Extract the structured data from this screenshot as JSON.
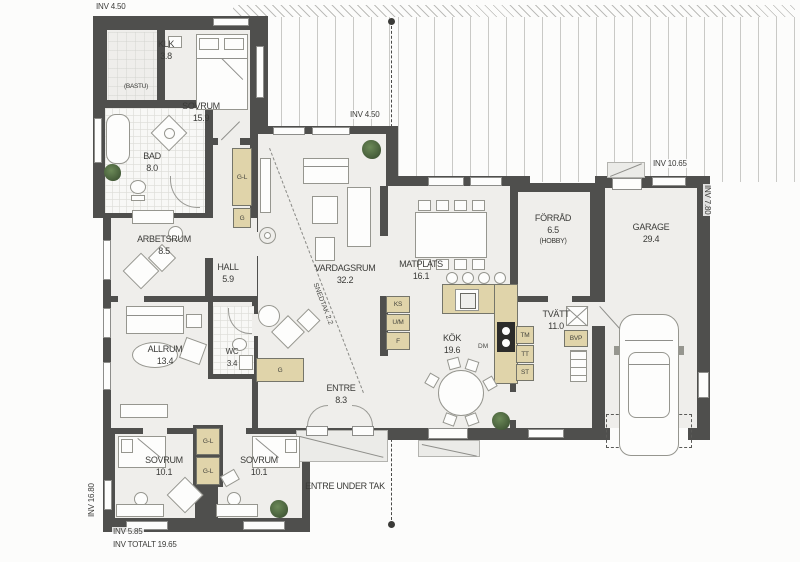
{
  "plan_title": "floor-plan",
  "rooms": {
    "klk": {
      "name": "KLK",
      "area": "3.8"
    },
    "bastu": {
      "name": "(BASTU)"
    },
    "sovrum1": {
      "name": "SOVRUM",
      "area": "15.9"
    },
    "bad": {
      "name": "BAD",
      "area": "8.0"
    },
    "arbetsrum": {
      "name": "ARBETSRUM",
      "area": "8.5"
    },
    "hall": {
      "name": "HALL",
      "area": "5.9"
    },
    "vardagsrum": {
      "name": "VARDAGSRUM",
      "area": "32.2"
    },
    "matplats": {
      "name": "MATPLATS",
      "area": "16.1"
    },
    "forrad": {
      "name": "FÖRRÅD",
      "area": "6.5",
      "extra": "(HOBBY)"
    },
    "garage": {
      "name": "GARAGE",
      "area": "29.4"
    },
    "kok": {
      "name": "KÖK",
      "area": "19.6"
    },
    "tvatt": {
      "name": "TVÄTT",
      "area": "11.0"
    },
    "allrum": {
      "name": "ALLRUM",
      "area": "13.4"
    },
    "wc": {
      "name": "WC",
      "area": "3.4"
    },
    "entre": {
      "name": "ENTRE",
      "area": "8.3"
    },
    "sovrum2": {
      "name": "SOVRUM",
      "area": "10.1"
    },
    "sovrum3": {
      "name": "SOVRUM",
      "area": "10.1"
    },
    "entre_under_tak": {
      "name": "ENTRE UNDER TAK"
    },
    "snedtak": {
      "name": "SNEDTAK 2.2"
    }
  },
  "dims": {
    "top_left": "INV 4.50",
    "mid": "INV 4.50",
    "garage_top": "INV 10.65",
    "right_side": "INV 7.80",
    "left_side": "INV 16.80",
    "bottom_width": "INV 5.85",
    "bottom_total": "INV TOTALT 19.65"
  },
  "fixtures": {
    "gl": "G-L",
    "g": "G",
    "ks": "KS",
    "um": "U/M",
    "f": "F",
    "dm": "DM",
    "tm": "TM",
    "tt": "TT",
    "st": "ST",
    "bvp": "BVP"
  },
  "colors": {
    "wall": "#4f4f4d",
    "floor": "#efeeeb",
    "cabinet": "#e0d4aa",
    "plant_green": "#35492c"
  }
}
